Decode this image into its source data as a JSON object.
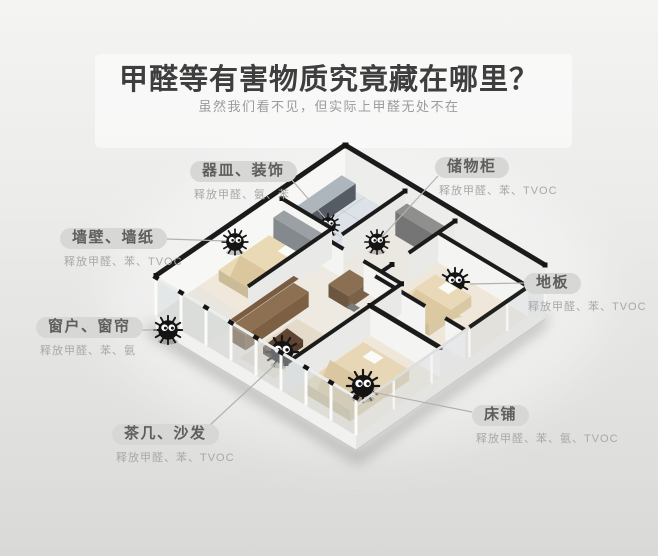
{
  "page": {
    "title": "甲醛等有害物质究竟藏在哪里？",
    "subtitle": "虽然我们看不见，但实际上甲醛无处不在"
  },
  "callouts": [
    {
      "id": "dishes-decor",
      "name": "器皿、装饰",
      "releases": "释放甲醛、氨、苯"
    },
    {
      "id": "storage-cabinet",
      "name": "储物柜",
      "releases": "释放甲醛、苯、TVOC"
    },
    {
      "id": "wall-wallpaper",
      "name": "墙壁、墙纸",
      "releases": "释放甲醛、苯、TVOC"
    },
    {
      "id": "floor",
      "name": "地板",
      "releases": "释放甲醛、苯、TVOC"
    },
    {
      "id": "window-curtain",
      "name": "窗户、窗帘",
      "releases": "释放甲醛、苯、氨"
    },
    {
      "id": "tea-table-sofa",
      "name": "茶几、沙发",
      "releases": "释放甲醛、苯、TVOC"
    },
    {
      "id": "bed",
      "name": "床铺",
      "releases": "释放甲醛、苯、氨、TVOC"
    }
  ],
  "colors": {
    "background": "#e2e2e1",
    "title_text": "#3e3e3e",
    "subtitle_text": "#9b9b99",
    "label_pill": "#d7d7d5",
    "label_text": "#5e5e5c",
    "wall_cap": "#1b1b1b",
    "mite_body": "#141414"
  }
}
